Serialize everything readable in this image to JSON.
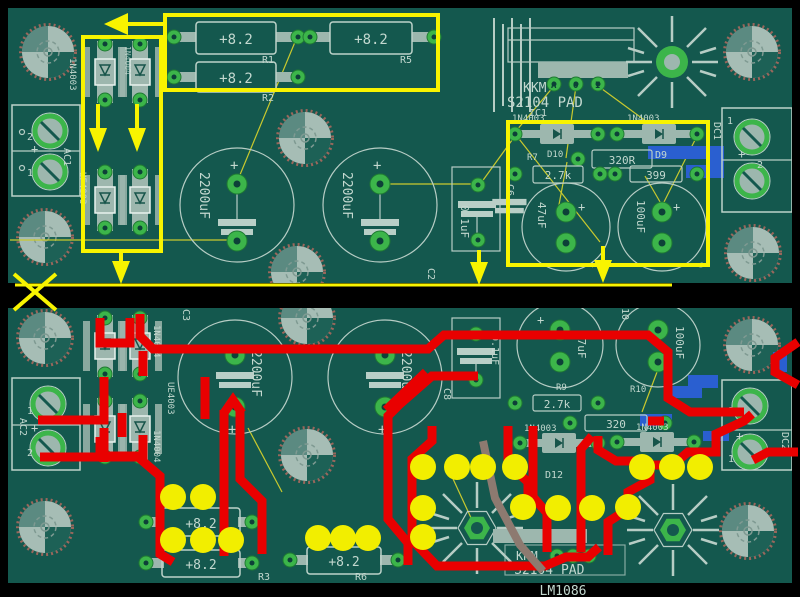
{
  "plus": "+",
  "colors": {
    "board": "#14584e",
    "silkscreen": "#bdd3ca",
    "pad_green": "#3cb54a",
    "annotation_yellow": "#f8f400",
    "annotation_red": "#e90000",
    "trace_blue": "#2a5fd0",
    "trace_gray": "#8d7a70",
    "via_dot_yellow": "#f2ee00"
  },
  "top": {
    "ac_ref": "AC1",
    "ac_pin_a": "2",
    "ac_pin_b": "1",
    "diode_left_1": "1N4003",
    "diode_left_2": "UF4003",
    "diode_pkg": "1N4004",
    "res_val": "+8.2",
    "r1": "R1",
    "r2": "R2",
    "r5": "R5",
    "cap_val": "2200uF",
    "c2": "C2",
    "film_val": "0.1uF",
    "c6": "C6",
    "c7": "7",
    "c9": "9",
    "brand": "KKM",
    "model": "S2104 PAD",
    "ic_ref": "IC1",
    "pin_a": "A",
    "pin_o": "O",
    "pin_i": "I",
    "d_lbl_1": "1N4003",
    "d_lbl_2": "1N4003",
    "d10": "D10",
    "d9": "D9",
    "r7": "R7",
    "r320": "320R",
    "r27k": "2.7k",
    "r399": "399",
    "c47": "47uF",
    "c100": "100uF",
    "dc_ref": "DC1",
    "dc_pin_a": "1",
    "dc_pin_b": "2"
  },
  "bottom": {
    "ac_ref": "AC2",
    "ac_pin_a": "1",
    "ac_pin_b": "2",
    "diode_pkg_1": "1N4004",
    "diode_pkg_2": "UE4003",
    "diode_pkg_3": "1N4004",
    "c3": "C3",
    "cap_val": "2200uF",
    "c10_partial": "10",
    "film_val": "0.1uF",
    "c8": "C8",
    "res_val": "+8.2",
    "r3": "R3",
    "r6": "R6",
    "d_lbl_1": "1N4003",
    "d_lbl_2": "1N4003",
    "d12": "D12",
    "r9": "R9",
    "r10": "R10",
    "r27k": "2.7k",
    "r320": "320",
    "c47": "47uF",
    "c100": "100uF",
    "brand": "KKM",
    "model": "S2104 PAD",
    "dc_ref": "DC2",
    "dc_pin_a": "2",
    "dc_pin_b": "1",
    "chip": "LM1086"
  }
}
